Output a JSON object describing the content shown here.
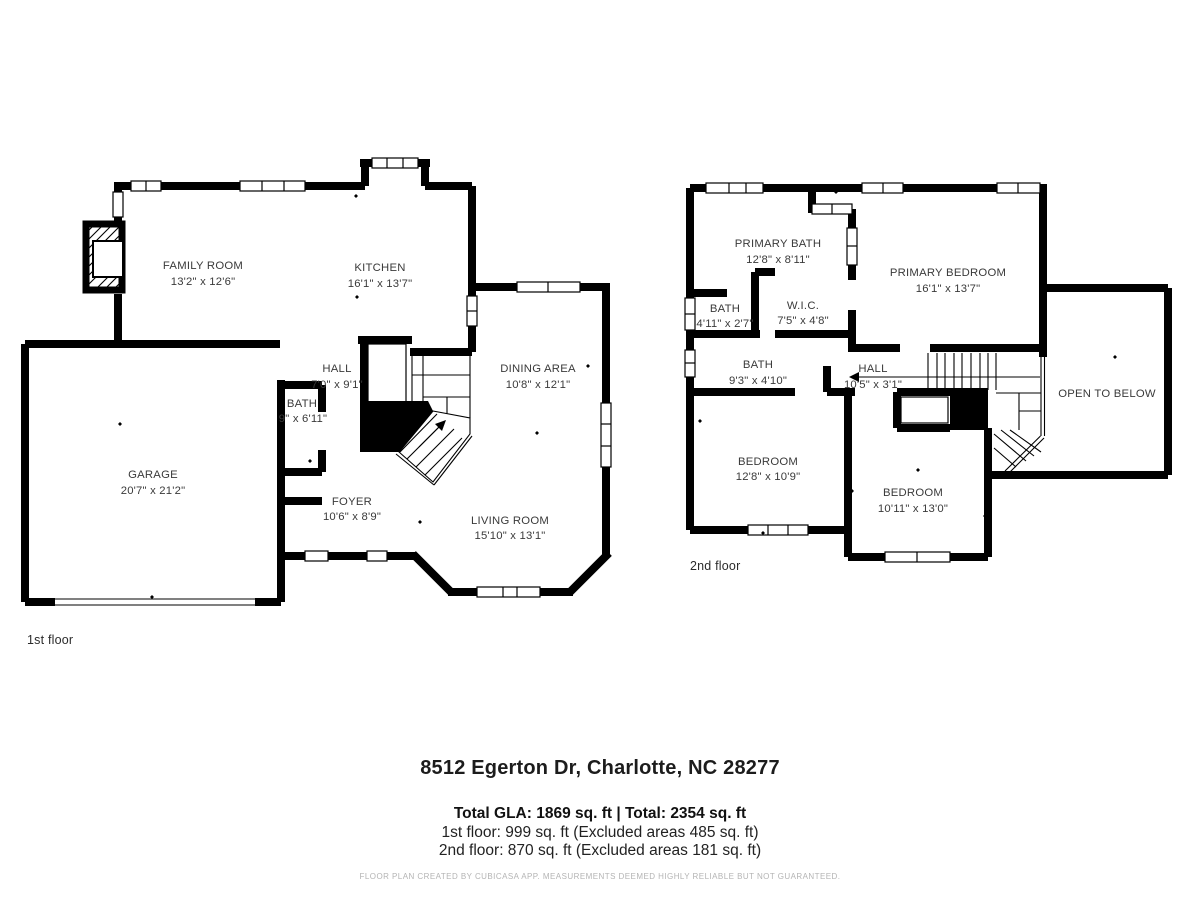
{
  "colors": {
    "wall": "#000000",
    "label": "#3a3a3a",
    "disclaimer_gray": "#b4b4b4",
    "background": "#ffffff"
  },
  "first_floor": {
    "floor_label": "1st floor",
    "rooms": [
      {
        "name": "FAMILY ROOM",
        "dims": "13'2\" x 12'6\""
      },
      {
        "name": "KITCHEN",
        "dims": "16'1\" x 13'7\""
      },
      {
        "name": "HALL",
        "dims": "7'0\" x 9'1\""
      },
      {
        "name": "BATH",
        "dims": "9\" x 6'11\""
      },
      {
        "name": "GARAGE",
        "dims": "20'7\" x 21'2\""
      },
      {
        "name": "FOYER",
        "dims": "10'6\" x 8'9\""
      },
      {
        "name": "DINING AREA",
        "dims": "10'8\" x 12'1\""
      },
      {
        "name": "LIVING ROOM",
        "dims": "15'10\" x 13'1\""
      }
    ]
  },
  "second_floor": {
    "floor_label": "2nd floor",
    "rooms": [
      {
        "name": "PRIMARY BATH",
        "dims": "12'8\" x 8'11\""
      },
      {
        "name": "BATH",
        "dims": "4'11\" x 2'7\""
      },
      {
        "name": "W.I.C.",
        "dims": "7'5\" x 4'8\""
      },
      {
        "name": "PRIMARY BEDROOM",
        "dims": "16'1\" x 13'7\""
      },
      {
        "name": "BATH",
        "dims": "9'3\" x 4'10\""
      },
      {
        "name": "HALL",
        "dims": "10'5\" x 3'1\""
      },
      {
        "name": "OPEN TO BELOW",
        "dims": ""
      },
      {
        "name": "BEDROOM",
        "dims": "12'8\" x 10'9\""
      },
      {
        "name": "BEDROOM",
        "dims": "10'11\" x 13'0\""
      }
    ]
  },
  "footer": {
    "address": "8512 Egerton Dr, Charlotte, NC 28277",
    "totals": "Total GLA: 1869 sq. ft | Total: 2354 sq. ft",
    "floor1_line": "1st floor: 999 sq. ft (Excluded areas 485 sq. ft)",
    "floor2_line": "2nd floor: 870 sq. ft (Excluded areas 181 sq. ft)",
    "disclaimer": "FLOOR PLAN CREATED BY CUBICASA APP. MEASUREMENTS DEEMED HIGHLY RELIABLE BUT NOT GUARANTEED."
  }
}
